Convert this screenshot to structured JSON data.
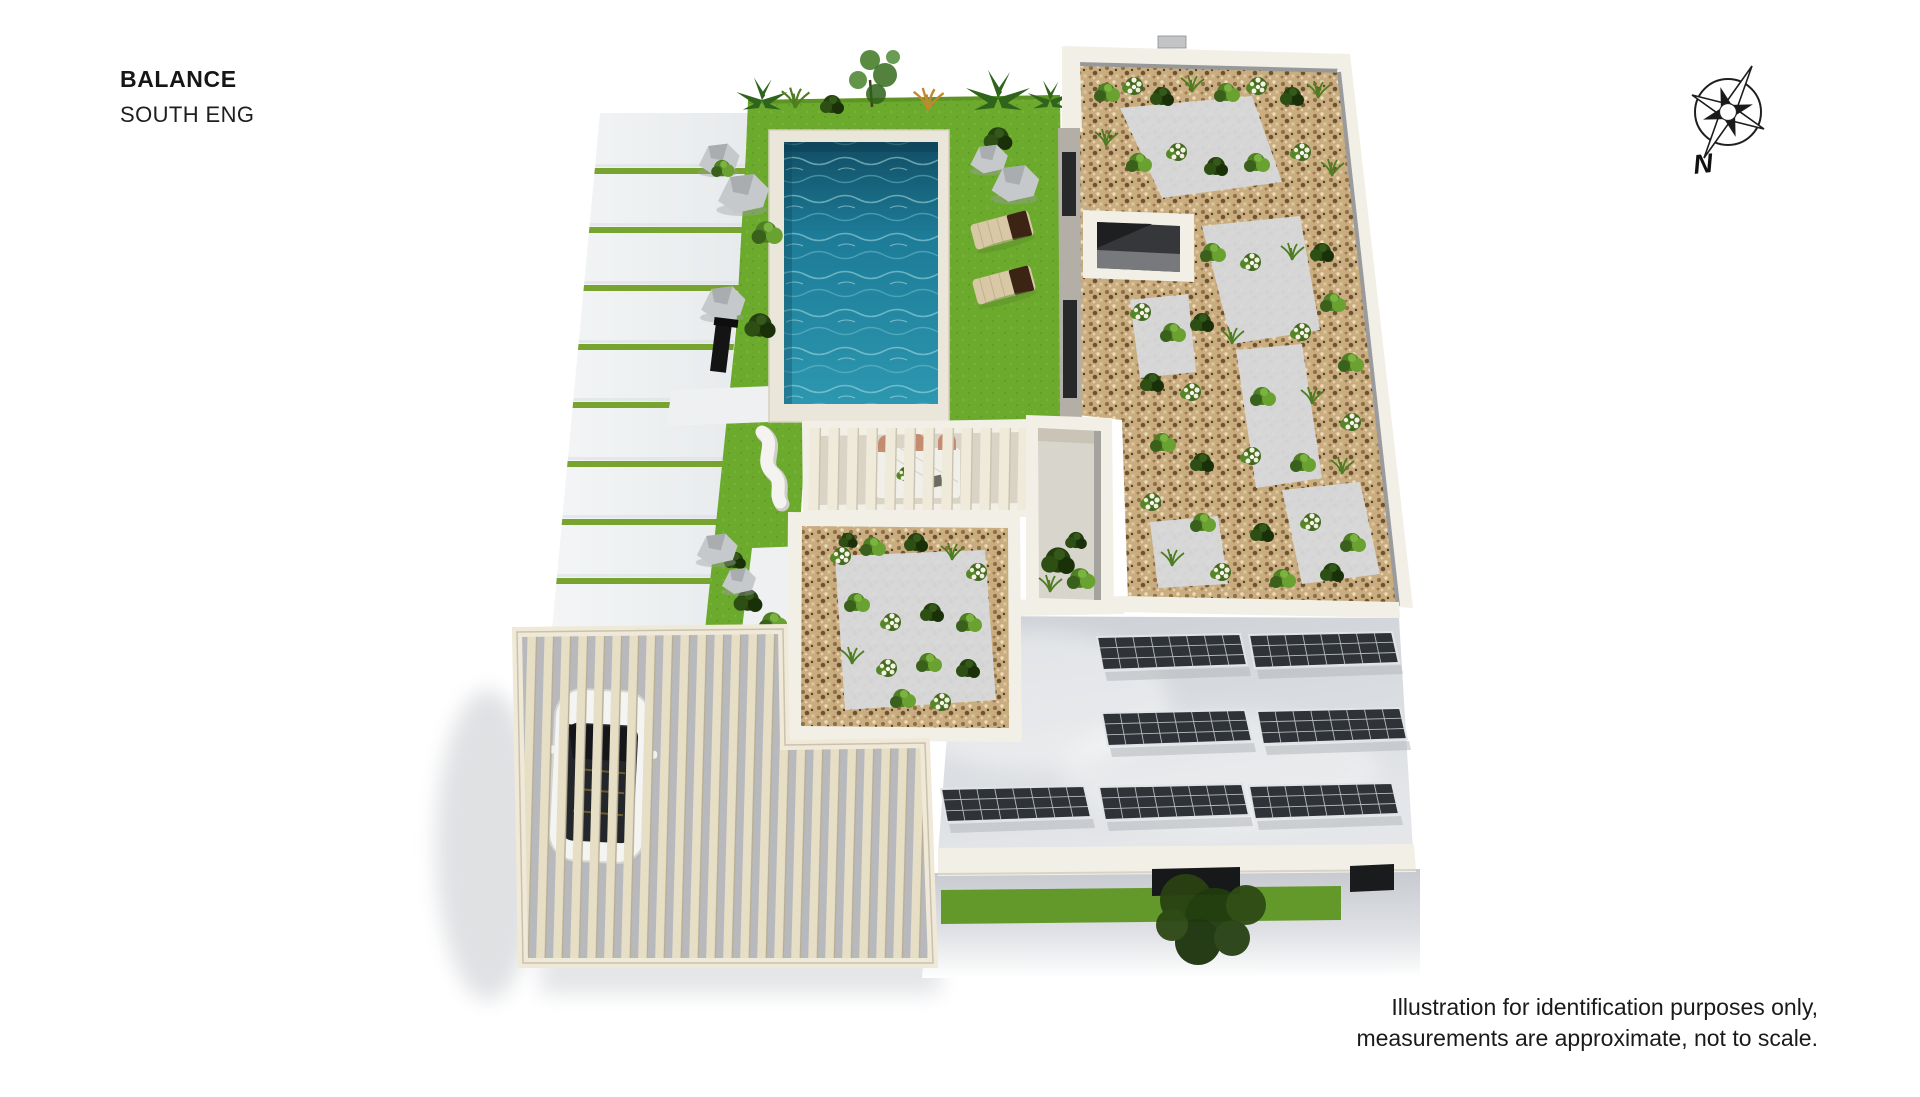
{
  "header": {
    "title": "BALANCE",
    "subtitle": "SOUTH ENG"
  },
  "compass": {
    "label": "N"
  },
  "footer": {
    "disclaimer_line1": "Illustration for identification purposes only,",
    "disclaimer_line2": "measurements are approximate, not to scale."
  },
  "colors": {
    "lawn": "#6caa2d",
    "lawn-strip": "#77a42e",
    "facade-lawn": "#63992a",
    "water-deep": "#124f66",
    "water-mid": "#1d7b97",
    "water-light": "#2d97b0",
    "deck": "#ebe6da",
    "gravel": "#c9ad80",
    "wall": "#f2efe7",
    "roof": "#d3d6da",
    "solar-panel": "#2f3337",
    "pergola-slat": "#e6ddc6"
  }
}
